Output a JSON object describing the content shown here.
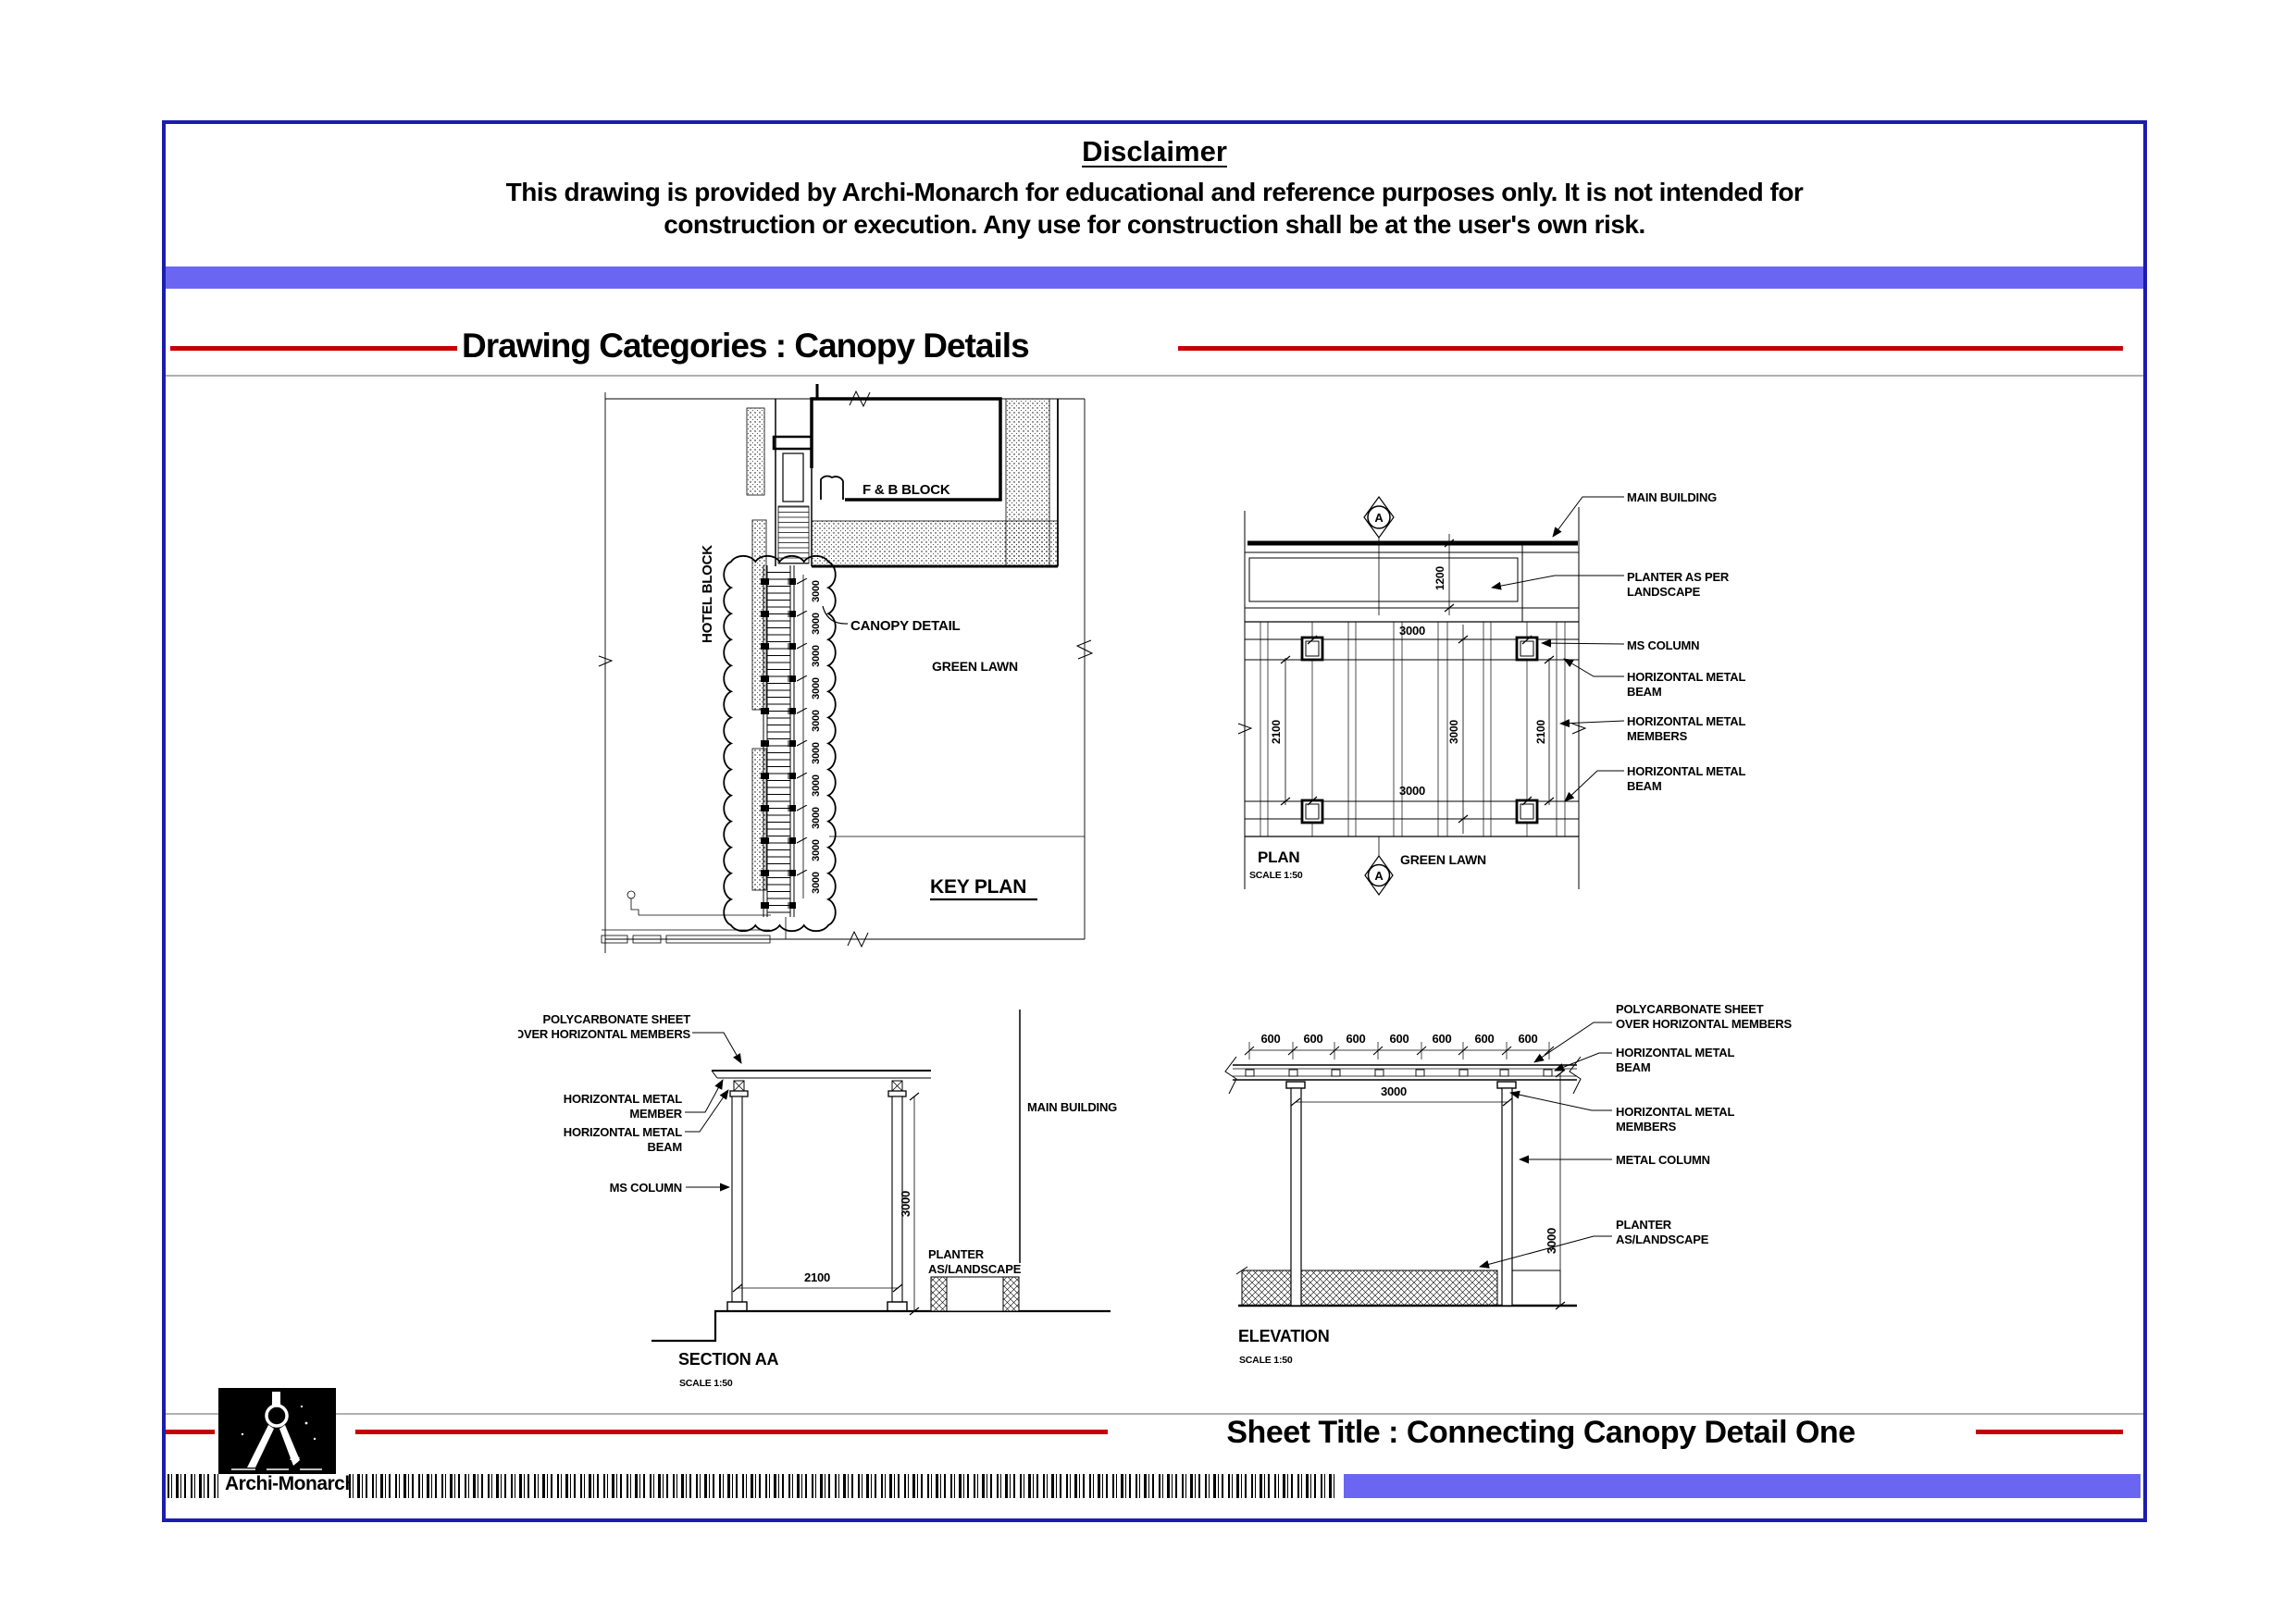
{
  "colors": {
    "accent_blue": "#6b66f2",
    "border_blue": "#1c1cae",
    "accent_red": "#c40000",
    "divider_gray": "#b0b0b0"
  },
  "disclaimer": {
    "title": "Disclaimer",
    "line1": "This drawing is provided by Archi-Monarch for educational and reference purposes only. It is not intended for",
    "line2": "construction or execution. Any use for construction shall be at the user's own risk."
  },
  "header": {
    "title": "Drawing Categories : Canopy Details"
  },
  "key_plan": {
    "title": "KEY PLAN",
    "hotel_block": "HOTEL BLOCK",
    "fb_block": "F & B BLOCK",
    "canopy_detail": "CANOPY DETAIL",
    "green_lawn": "GREEN LAWN",
    "bay_dims": [
      "3000",
      "3000",
      "3000",
      "3000",
      "3000",
      "3000",
      "3000",
      "3000",
      "3000",
      "3000"
    ]
  },
  "plan": {
    "title": "PLAN",
    "scale": "SCALE 1:50",
    "green_lawn": "GREEN LAWN",
    "marker_top": "A",
    "marker_bottom": "A",
    "dim_planter": "1200",
    "dim_top": "3000",
    "dim_bottom": "3000",
    "dim_left": "2100",
    "dim_right": "2100",
    "dim_mid": "3000",
    "co_main": "MAIN BUILDING",
    "co_planter1": "PLANTER AS PER",
    "co_planter2": "LANDSCAPE",
    "co_column": "MS COLUMN",
    "co_beam1a": "HORIZONTAL METAL",
    "co_beam1b": "BEAM",
    "co_mem_a": "HORIZONTAL METAL",
    "co_mem_b": "MEMBERS",
    "co_beam2a": "HORIZONTAL METAL",
    "co_beam2b": "BEAM"
  },
  "section": {
    "title": "SECTION AA",
    "scale": "SCALE 1:50",
    "poly1": "POLYCARBONATE SHEET",
    "poly2": "OVER HORIZONTAL MEMBERS",
    "mem1": "HORIZONTAL METAL",
    "mem2": "MEMBER",
    "beam1": "HORIZONTAL METAL",
    "beam2": "BEAM",
    "ms_column": "MS COLUMN",
    "main_building": "MAIN BUILDING",
    "planter1": "PLANTER",
    "planter2": "AS/LANDSCAPE",
    "dim_width": "2100",
    "dim_height": "3000"
  },
  "elevation": {
    "title": "ELEVATION",
    "scale": "SCALE 1:50",
    "top_dims": [
      "600",
      "600",
      "600",
      "600",
      "600",
      "600",
      "600"
    ],
    "dim_bay": "3000",
    "dim_height": "3000",
    "poly1": "POLYCARBONATE SHEET",
    "poly2": "OVER HORIZONTAL MEMBERS",
    "beam1": "HORIZONTAL METAL",
    "beam2": "BEAM",
    "mem1": "HORIZONTAL METAL",
    "mem2": "MEMBERS",
    "metal_column": "METAL COLUMN",
    "planter1": "PLANTER",
    "planter2": "AS/LANDSCAPE"
  },
  "footer": {
    "sheet_title": "Sheet Title : Connecting Canopy Detail One",
    "brand": "Archi-Monarch"
  }
}
